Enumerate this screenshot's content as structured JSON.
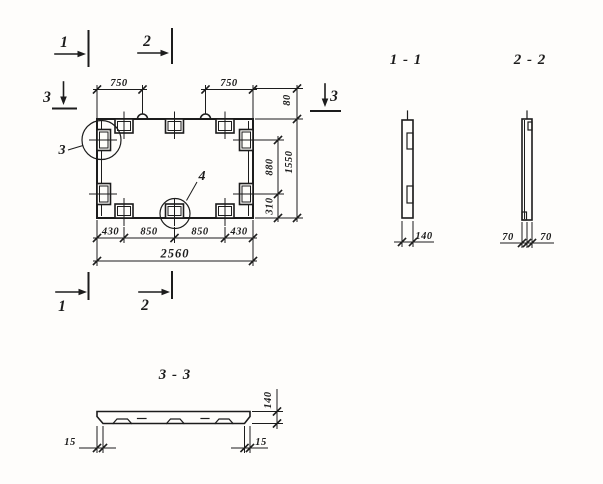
{
  "plan": {
    "section_marks": {
      "mark1": "1",
      "mark2": "2",
      "mark3": "3"
    },
    "detail_callouts": {
      "detail3": "3",
      "detail4": "4"
    },
    "dims": {
      "top": [
        "750",
        "750"
      ],
      "bottom_row": [
        "430",
        "850",
        "850",
        "430"
      ],
      "bottom_total": "2560",
      "right_offset": "80",
      "right_upper": "880",
      "right_lower": "310",
      "right_total": "1550"
    }
  },
  "section_1_1": {
    "title": "1 - 1",
    "dim_width": "140"
  },
  "section_2_2": {
    "title": "2 - 2",
    "dim_left": "70",
    "dim_right": "70"
  },
  "section_3_3": {
    "title": "3 - 3",
    "dim_left": "15",
    "dim_right": "15",
    "dim_height": "140"
  },
  "colors": {
    "ink": "#1c1c1c",
    "paper": "#fefdfb"
  }
}
